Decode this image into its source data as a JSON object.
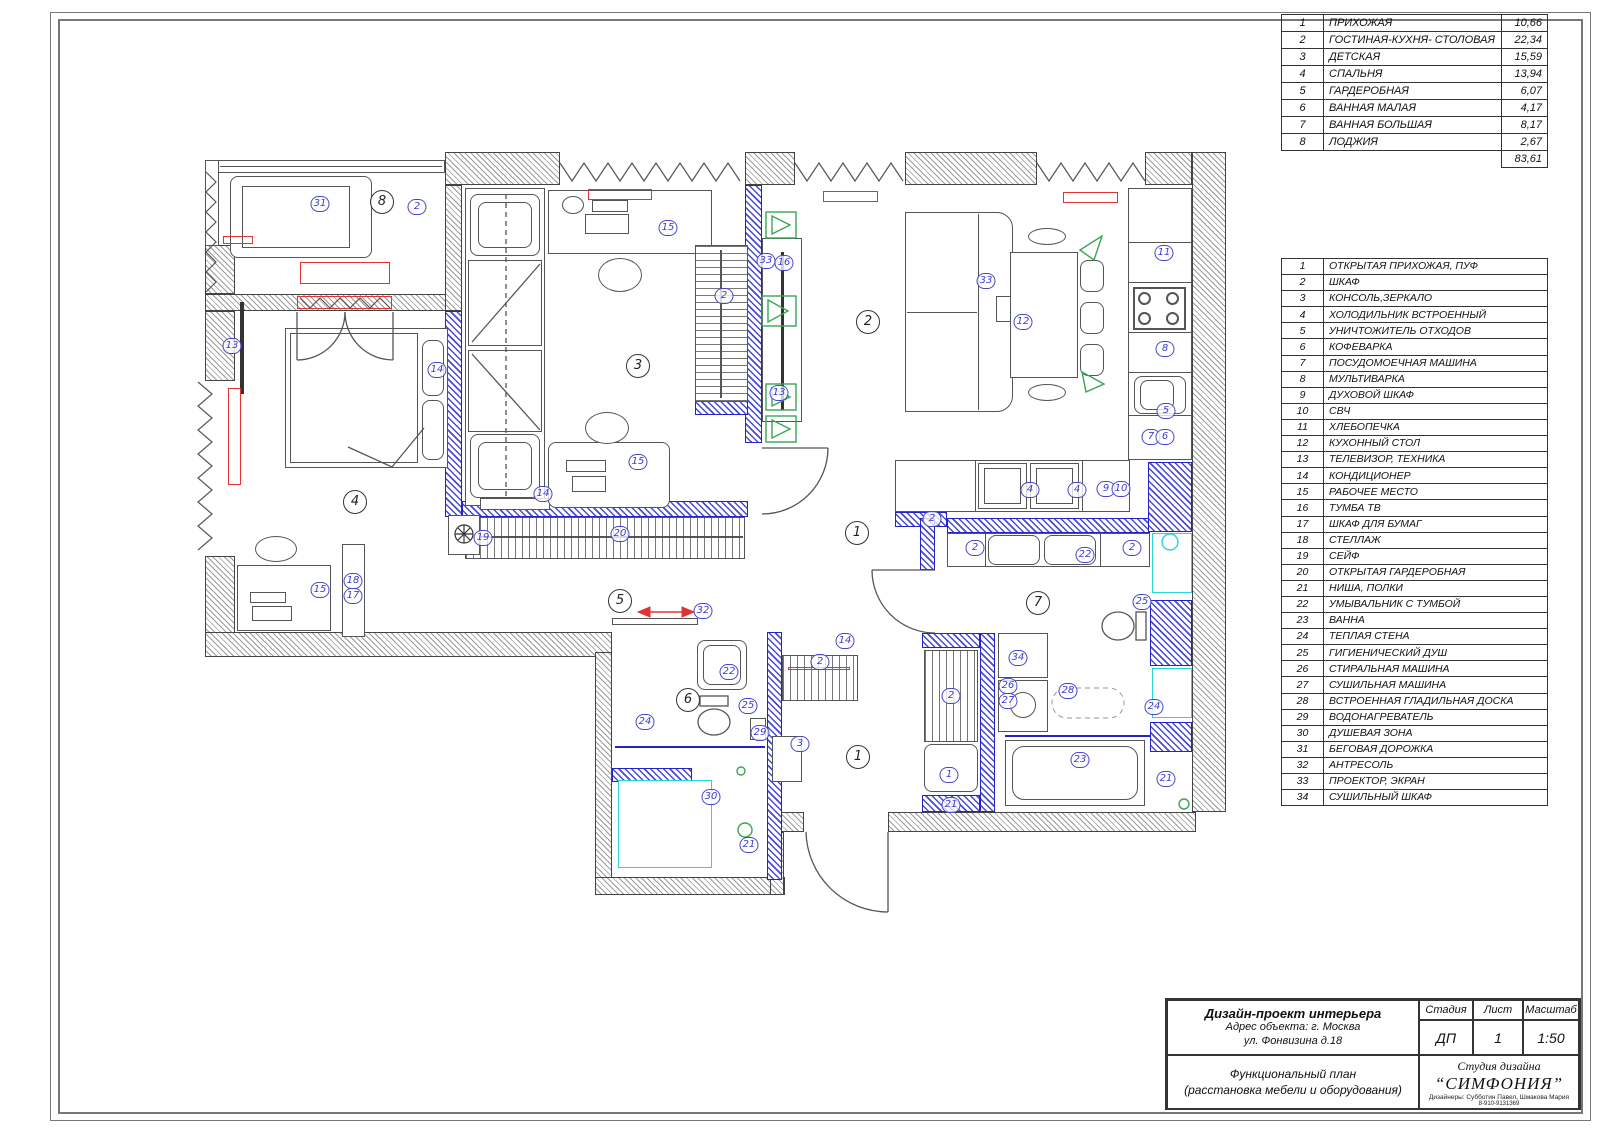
{
  "room_table": {
    "rows": [
      {
        "num": "1",
        "name": "ПРИХОЖАЯ",
        "area": "10,66"
      },
      {
        "num": "2",
        "name": "ГОСТИНАЯ-КУХНЯ- СТОЛОВАЯ",
        "area": "22,34"
      },
      {
        "num": "3",
        "name": "ДЕТСКАЯ",
        "area": "15,59"
      },
      {
        "num": "4",
        "name": "СПАЛЬНЯ",
        "area": "13,94"
      },
      {
        "num": "5",
        "name": "ГАРДЕРОБНАЯ",
        "area": "6,07"
      },
      {
        "num": "6",
        "name": "ВАННАЯ МАЛАЯ",
        "area": "4,17"
      },
      {
        "num": "7",
        "name": "ВАННАЯ БОЛЬШАЯ",
        "area": "8,17"
      },
      {
        "num": "8",
        "name": "ЛОДЖИЯ",
        "area": "2,67"
      }
    ],
    "total_area": "83,61"
  },
  "legend_table": {
    "rows": [
      {
        "num": "1",
        "name": "ОТКРЫТАЯ ПРИХОЖАЯ, ПУФ"
      },
      {
        "num": "2",
        "name": "ШКАФ"
      },
      {
        "num": "3",
        "name": "КОНСОЛЬ,ЗЕРКАЛО"
      },
      {
        "num": "4",
        "name": "ХОЛОДИЛЬНИК ВСТРОЕННЫЙ"
      },
      {
        "num": "5",
        "name": "УНИЧТОЖИТЕЛЬ ОТХОДОВ"
      },
      {
        "num": "6",
        "name": "КОФЕВАРКА"
      },
      {
        "num": "7",
        "name": "ПОСУДОМОЕЧНАЯ МАШИНА"
      },
      {
        "num": "8",
        "name": "МУЛЬТИВАРКА"
      },
      {
        "num": "9",
        "name": "ДУХОВОЙ ШКАФ"
      },
      {
        "num": "10",
        "name": "СВЧ"
      },
      {
        "num": "11",
        "name": "ХЛЕБОПЕЧКА"
      },
      {
        "num": "12",
        "name": "КУХОННЫЙ СТОЛ"
      },
      {
        "num": "13",
        "name": "ТЕЛЕВИЗОР, ТЕХНИКА"
      },
      {
        "num": "14",
        "name": "КОНДИЦИОНЕР"
      },
      {
        "num": "15",
        "name": "РАБОЧЕЕ МЕСТО"
      },
      {
        "num": "16",
        "name": "ТУМБА ТВ"
      },
      {
        "num": "17",
        "name": "ШКАФ ДЛЯ БУМАГ"
      },
      {
        "num": "18",
        "name": "СТЕЛЛАЖ"
      },
      {
        "num": "19",
        "name": "СЕЙФ"
      },
      {
        "num": "20",
        "name": "ОТКРЫТАЯ ГАРДЕРОБНАЯ"
      },
      {
        "num": "21",
        "name": "НИША, ПОЛКИ"
      },
      {
        "num": "22",
        "name": "УМЫВАЛЬНИК С ТУМБОЙ"
      },
      {
        "num": "23",
        "name": "ВАННА"
      },
      {
        "num": "24",
        "name": "ТЕПЛАЯ СТЕНА"
      },
      {
        "num": "25",
        "name": "ГИГИЕНИЧЕСКИЙ ДУШ"
      },
      {
        "num": "26",
        "name": "СТИРАЛЬНАЯ МАШИНА"
      },
      {
        "num": "27",
        "name": "СУШИЛЬНАЯ МАШИНА"
      },
      {
        "num": "28",
        "name": "ВСТРОЕННАЯ ГЛАДИЛЬНАЯ ДОСКА"
      },
      {
        "num": "29",
        "name": "ВОДОНАГРЕВАТЕЛЬ"
      },
      {
        "num": "30",
        "name": "ДУШЕВАЯ ЗОНА"
      },
      {
        "num": "31",
        "name": "БЕГОВАЯ ДОРОЖКА"
      },
      {
        "num": "32",
        "name": "АНТРЕСОЛЬ"
      },
      {
        "num": "33",
        "name": "ПРОЕКТОР, ЭКРАН"
      },
      {
        "num": "34",
        "name": "СУШИЛЬНЫЙ ШКАФ"
      }
    ]
  },
  "title_block": {
    "title": "Дизайн-проект интерьера",
    "address_line1": "Адрес объекта: г. Москва",
    "address_line2": "ул. Фонвизина д.18",
    "stage_label": "Стадия",
    "sheet_label": "Лист",
    "scale_label": "Масштаб",
    "stage": "ДП",
    "sheet": "1",
    "scale": "1:50",
    "drawing_name_line1": "Функциональный план",
    "drawing_name_line2": "(расстановка мебели и оборудования)",
    "studio_type": "Студия дизайна",
    "studio_name": "“СИМФОНИЯ”",
    "designers": "Дизайнеры: Субботин Павел, Шмакова Мария",
    "phone": "8-910-9131369"
  },
  "plan": {
    "colors": {
      "wall_blue": "#2323c8",
      "hatch_gray": "#9a9a9a",
      "label_blue": "#3b3bd0",
      "radiator_red": "#e23333",
      "fixture_cyan": "#2ad4d4",
      "speaker_green": "#3aa655"
    },
    "room_circles": [
      {
        "n": "8",
        "x": 382,
        "y": 202
      },
      {
        "n": "4",
        "x": 355,
        "y": 502
      },
      {
        "n": "3",
        "x": 638,
        "y": 366
      },
      {
        "n": "2",
        "x": 868,
        "y": 322
      },
      {
        "n": "1",
        "x": 857,
        "y": 533
      },
      {
        "n": "5",
        "x": 620,
        "y": 601
      },
      {
        "n": "6",
        "x": 688,
        "y": 700
      },
      {
        "n": "7",
        "x": 1038,
        "y": 603
      },
      {
        "n": "1",
        "x": 858,
        "y": 757
      }
    ],
    "item_labels": [
      {
        "n": "31",
        "x": 320,
        "y": 204
      },
      {
        "n": "2",
        "x": 417,
        "y": 207
      },
      {
        "n": "13",
        "x": 232,
        "y": 346
      },
      {
        "n": "14",
        "x": 437,
        "y": 370
      },
      {
        "n": "15",
        "x": 320,
        "y": 590
      },
      {
        "n": "18",
        "x": 353,
        "y": 581
      },
      {
        "n": "17",
        "x": 353,
        "y": 596
      },
      {
        "n": "15",
        "x": 668,
        "y": 228
      },
      {
        "n": "2",
        "x": 724,
        "y": 296
      },
      {
        "n": "15",
        "x": 638,
        "y": 462
      },
      {
        "n": "14",
        "x": 543,
        "y": 494
      },
      {
        "n": "19",
        "x": 483,
        "y": 538
      },
      {
        "n": "20",
        "x": 620,
        "y": 534
      },
      {
        "n": "32",
        "x": 703,
        "y": 611
      },
      {
        "n": "33",
        "x": 766,
        "y": 261
      },
      {
        "n": "16",
        "x": 784,
        "y": 263
      },
      {
        "n": "13",
        "x": 779,
        "y": 393
      },
      {
        "n": "33",
        "x": 986,
        "y": 281
      },
      {
        "n": "12",
        "x": 1023,
        "y": 322
      },
      {
        "n": "11",
        "x": 1164,
        "y": 253
      },
      {
        "n": "8",
        "x": 1165,
        "y": 349
      },
      {
        "n": "5",
        "x": 1166,
        "y": 411
      },
      {
        "n": "7",
        "x": 1151,
        "y": 437
      },
      {
        "n": "6",
        "x": 1165,
        "y": 437
      },
      {
        "n": "2",
        "x": 932,
        "y": 519
      },
      {
        "n": "4",
        "x": 1030,
        "y": 490
      },
      {
        "n": "4",
        "x": 1077,
        "y": 490
      },
      {
        "n": "9",
        "x": 1106,
        "y": 489
      },
      {
        "n": "10",
        "x": 1121,
        "y": 489
      },
      {
        "n": "2",
        "x": 975,
        "y": 548
      },
      {
        "n": "22",
        "x": 1085,
        "y": 555
      },
      {
        "n": "2",
        "x": 1132,
        "y": 548
      },
      {
        "n": "25",
        "x": 1142,
        "y": 602
      },
      {
        "n": "34",
        "x": 1018,
        "y": 658
      },
      {
        "n": "26",
        "x": 1008,
        "y": 686
      },
      {
        "n": "27",
        "x": 1008,
        "y": 701
      },
      {
        "n": "28",
        "x": 1068,
        "y": 691
      },
      {
        "n": "24",
        "x": 1154,
        "y": 707
      },
      {
        "n": "23",
        "x": 1080,
        "y": 760
      },
      {
        "n": "21",
        "x": 1166,
        "y": 779
      },
      {
        "n": "2",
        "x": 820,
        "y": 662
      },
      {
        "n": "14",
        "x": 845,
        "y": 641
      },
      {
        "n": "3",
        "x": 800,
        "y": 744
      },
      {
        "n": "2",
        "x": 951,
        "y": 696
      },
      {
        "n": "1",
        "x": 949,
        "y": 775
      },
      {
        "n": "21",
        "x": 951,
        "y": 805
      },
      {
        "n": "22",
        "x": 729,
        "y": 672
      },
      {
        "n": "25",
        "x": 748,
        "y": 706
      },
      {
        "n": "29",
        "x": 760,
        "y": 733
      },
      {
        "n": "24",
        "x": 645,
        "y": 722
      },
      {
        "n": "30",
        "x": 711,
        "y": 797
      },
      {
        "n": "21",
        "x": 749,
        "y": 845
      }
    ]
  }
}
